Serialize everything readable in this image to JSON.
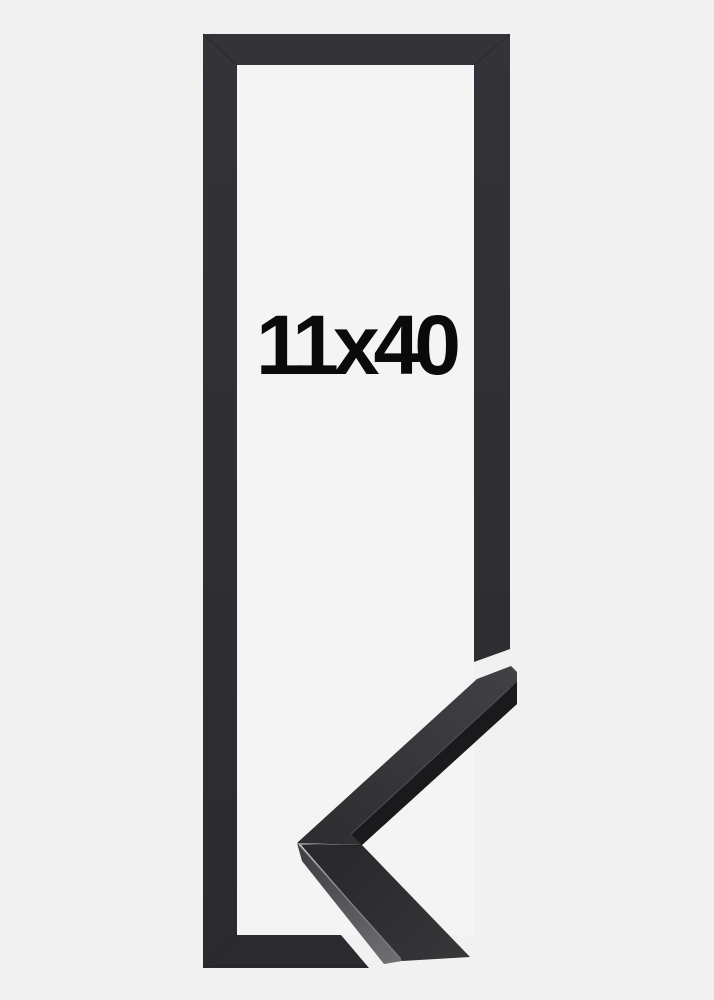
{
  "product_image": {
    "size_label": "11x40",
    "colors": {
      "bg": "#f1f1f2",
      "inner": "#f4f4f5",
      "frame_top": "#343338",
      "frame_bottom": "#2b2a2e",
      "corner_tip": "#414145",
      "corner_deep": "#2d2d30",
      "lower_top_a": "#2a2a2d",
      "lower_top_b": "#37373a",
      "side_a": "#3d3d41",
      "side_b": "#6f6f73",
      "edge_dark": "#1a1a1d",
      "ridge_upper": "#55555a",
      "ridge_lower": "#7e7e82",
      "seam": "#1c1c1f",
      "text": "#0a0a0a"
    }
  }
}
